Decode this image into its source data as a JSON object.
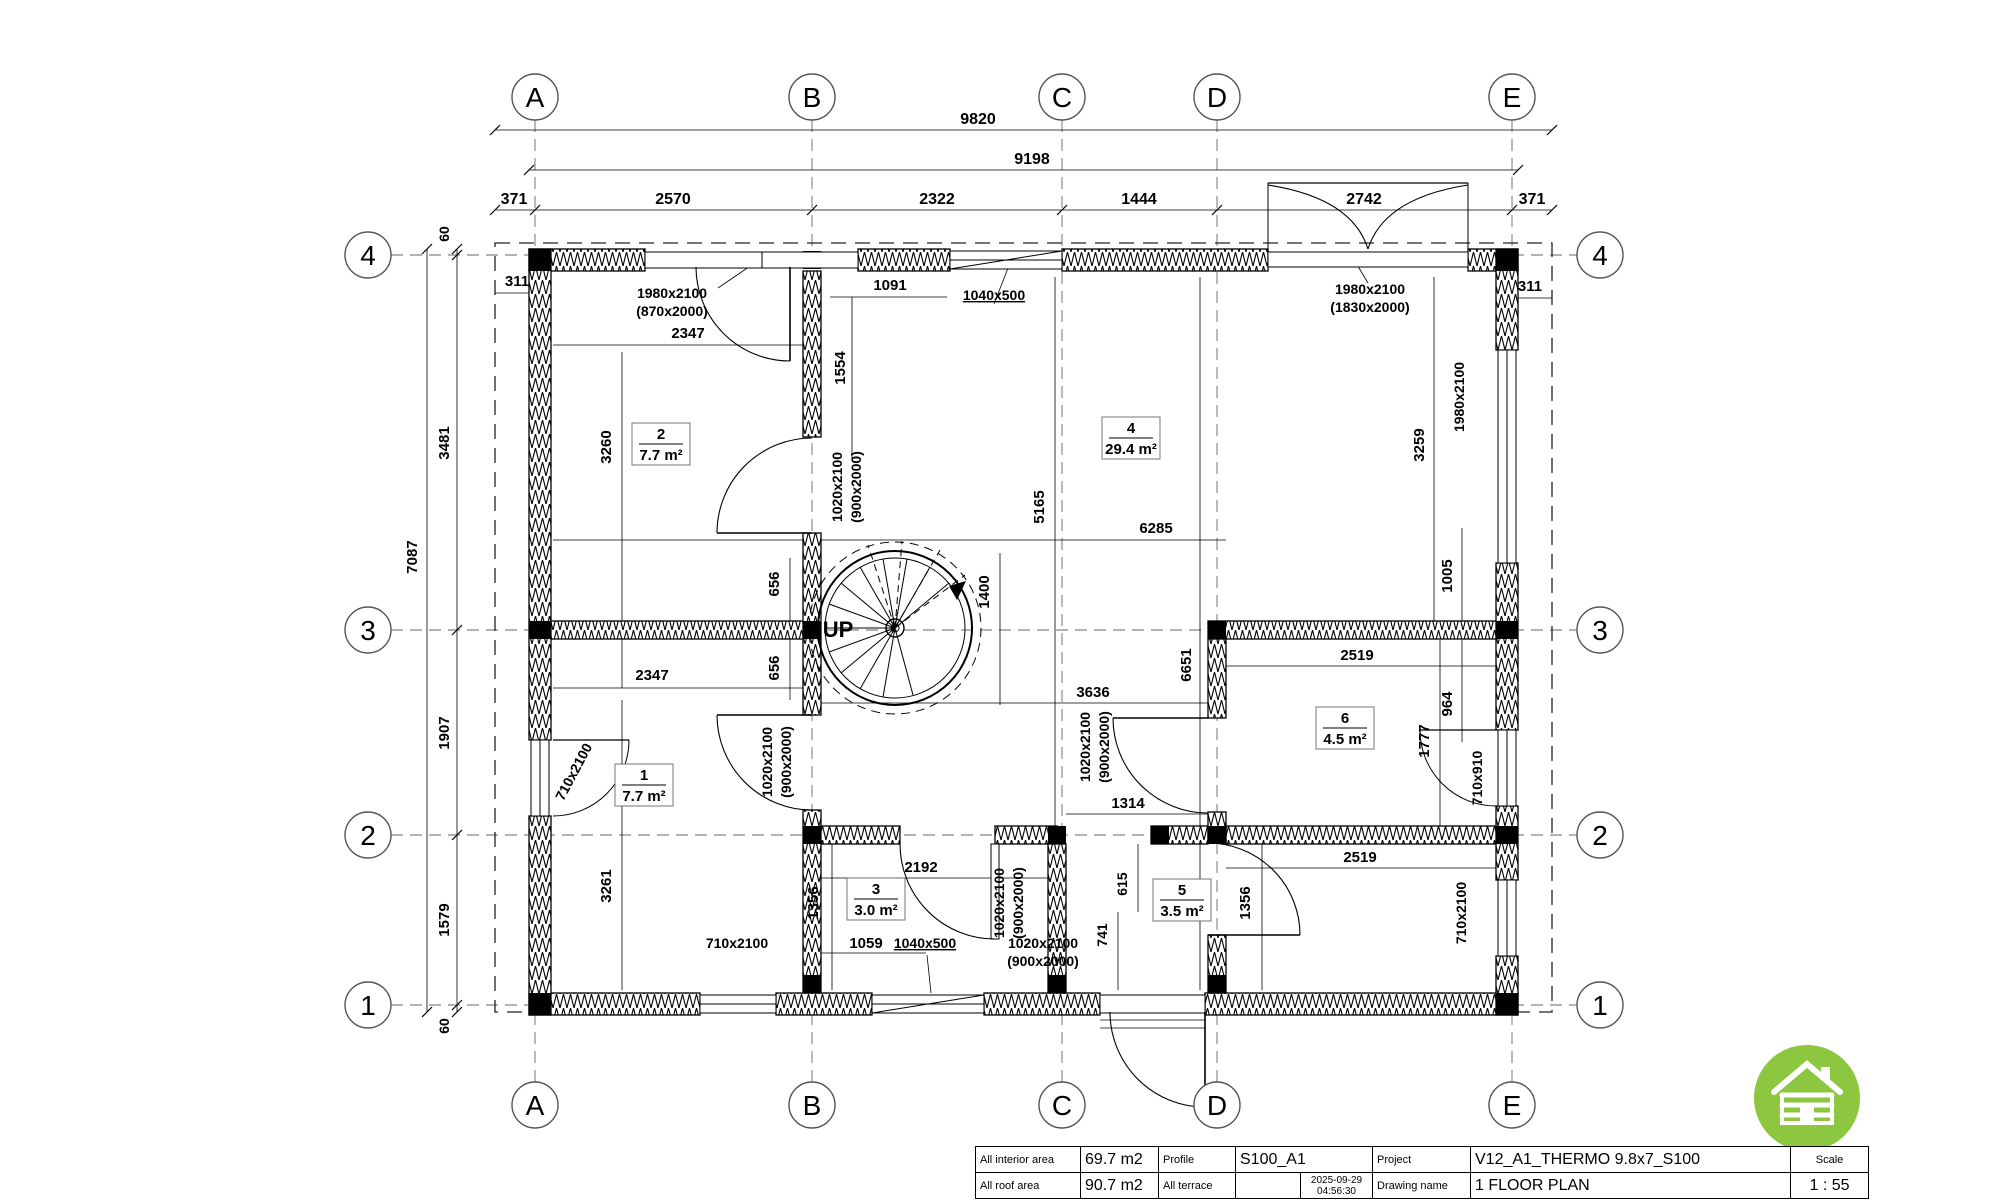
{
  "page": {
    "bg": "#ffffff",
    "line_color": "#000000",
    "accent_green": "#8dc63f"
  },
  "grid": {
    "col_labels": [
      "A",
      "B",
      "C",
      "D",
      "E"
    ],
    "row_labels": [
      "4",
      "3",
      "2",
      "1"
    ]
  },
  "bubbles": [
    {
      "t": "A",
      "x": 535,
      "y": 97
    },
    {
      "t": "B",
      "x": 812,
      "y": 97
    },
    {
      "t": "C",
      "x": 1062,
      "y": 97
    },
    {
      "t": "D",
      "x": 1217,
      "y": 97
    },
    {
      "t": "E",
      "x": 1512,
      "y": 97
    },
    {
      "t": "A",
      "x": 535,
      "y": 1105
    },
    {
      "t": "B",
      "x": 812,
      "y": 1105
    },
    {
      "t": "C",
      "x": 1062,
      "y": 1105
    },
    {
      "t": "D",
      "x": 1217,
      "y": 1105
    },
    {
      "t": "E",
      "x": 1512,
      "y": 1105
    },
    {
      "t": "4",
      "x": 368,
      "y": 255
    },
    {
      "t": "3",
      "x": 368,
      "y": 630
    },
    {
      "t": "2",
      "x": 368,
      "y": 835
    },
    {
      "t": "1",
      "x": 368,
      "y": 1005
    },
    {
      "t": "4",
      "x": 1600,
      "y": 255
    },
    {
      "t": "3",
      "x": 1600,
      "y": 630
    },
    {
      "t": "2",
      "x": 1600,
      "y": 835
    },
    {
      "t": "1",
      "x": 1600,
      "y": 1005
    }
  ],
  "annotations": [
    {
      "t": "9820",
      "x": 978,
      "y": 124,
      "s": 16
    },
    {
      "t": "9198",
      "x": 1032,
      "y": 164,
      "s": 16
    },
    {
      "t": "371",
      "x": 514,
      "y": 204,
      "s": 16
    },
    {
      "t": "2570",
      "x": 673,
      "y": 204,
      "s": 16
    },
    {
      "t": "2322",
      "x": 937,
      "y": 204,
      "s": 16
    },
    {
      "t": "1444",
      "x": 1139,
      "y": 204,
      "s": 16
    },
    {
      "t": "2742",
      "x": 1364,
      "y": 204,
      "s": 16
    },
    {
      "t": "371",
      "x": 1532,
      "y": 204,
      "s": 16
    },
    {
      "t": "311",
      "x": 517,
      "y": 286,
      "s": 15
    },
    {
      "t": "311",
      "x": 1530,
      "y": 291,
      "s": 15
    },
    {
      "t": "60",
      "x": 449,
      "y": 234,
      "r": -90,
      "s": 14
    },
    {
      "t": "3481",
      "x": 449,
      "y": 443,
      "r": -90,
      "s": 15
    },
    {
      "t": "1907",
      "x": 449,
      "y": 733,
      "r": -90,
      "s": 15
    },
    {
      "t": "1579",
      "x": 449,
      "y": 920,
      "r": -90,
      "s": 15
    },
    {
      "t": "60",
      "x": 449,
      "y": 1026,
      "r": -90,
      "s": 14
    },
    {
      "t": "7087",
      "x": 417,
      "y": 557,
      "r": -90,
      "s": 15
    },
    {
      "t": "1980x2100",
      "x": 672,
      "y": 298,
      "s": 14,
      "n": "door-size-label"
    },
    {
      "t": "(870x2000)",
      "x": 672,
      "y": 316,
      "s": 14,
      "n": "door-size-label"
    },
    {
      "t": "1040x500",
      "x": 994,
      "y": 300,
      "s": 14,
      "u": 1,
      "n": "window-size-label"
    },
    {
      "t": "1980x2100",
      "x": 1370,
      "y": 294,
      "s": 14,
      "n": "door-size-label"
    },
    {
      "t": "(1830x2000)",
      "x": 1370,
      "y": 312,
      "s": 14,
      "n": "door-size-label"
    },
    {
      "t": "1980x2100",
      "x": 1464,
      "y": 397,
      "r": -90,
      "s": 14,
      "n": "window-size-label"
    },
    {
      "t": "710x2100",
      "x": 578,
      "y": 774,
      "r": -62,
      "s": 14,
      "n": "window-size-label"
    },
    {
      "t": "1020x2100",
      "x": 842,
      "y": 487,
      "r": -90,
      "s": 14,
      "n": "door-size-label"
    },
    {
      "t": "(900x2000)",
      "x": 861,
      "y": 487,
      "r": -90,
      "s": 14,
      "n": "door-size-label"
    },
    {
      "t": "1020x2100",
      "x": 772,
      "y": 762,
      "r": -90,
      "s": 14,
      "n": "door-size-label"
    },
    {
      "t": "(900x2000)",
      "x": 791,
      "y": 762,
      "r": -90,
      "s": 14,
      "n": "door-size-label"
    },
    {
      "t": "1020x2100",
      "x": 1090,
      "y": 747,
      "r": -90,
      "s": 14,
      "n": "door-size-label"
    },
    {
      "t": "(900x2000)",
      "x": 1109,
      "y": 747,
      "r": -90,
      "s": 14,
      "n": "door-size-label"
    },
    {
      "t": "1020x2100",
      "x": 1004,
      "y": 903,
      "r": -90,
      "s": 14,
      "n": "door-size-label"
    },
    {
      "t": "(900x2000)",
      "x": 1023,
      "y": 903,
      "r": -90,
      "s": 14,
      "n": "door-size-label"
    },
    {
      "t": "710x910",
      "x": 1482,
      "y": 778,
      "r": -90,
      "s": 14,
      "n": "window-size-label"
    },
    {
      "t": "710x2100",
      "x": 1466,
      "y": 913,
      "r": -90,
      "s": 14,
      "n": "window-size-label"
    },
    {
      "t": "710x2100",
      "x": 737,
      "y": 948,
      "s": 14,
      "n": "window-size-label"
    },
    {
      "t": "1040x500",
      "x": 925,
      "y": 948,
      "s": 14,
      "u": 1,
      "n": "window-size-label"
    },
    {
      "t": "1020x2100",
      "x": 1043,
      "y": 948,
      "s": 14,
      "n": "door-size-label"
    },
    {
      "t": "(900x2000)",
      "x": 1043,
      "y": 966,
      "s": 14,
      "n": "door-size-label"
    },
    {
      "t": "2347",
      "x": 688,
      "y": 338,
      "s": 15
    },
    {
      "t": "1091",
      "x": 890,
      "y": 290,
      "s": 15
    },
    {
      "t": "1554",
      "x": 845,
      "y": 368,
      "r": -90,
      "s": 15
    },
    {
      "t": "3260",
      "x": 611,
      "y": 447,
      "r": -90,
      "s": 15
    },
    {
      "t": "3259",
      "x": 1424,
      "y": 445,
      "r": -90,
      "s": 15
    },
    {
      "t": "1005",
      "x": 1452,
      "y": 576,
      "r": -90,
      "s": 15
    },
    {
      "t": "5165",
      "x": 1044,
      "y": 507,
      "r": -90,
      "s": 15
    },
    {
      "t": "6285",
      "x": 1156,
      "y": 533,
      "s": 15
    },
    {
      "t": "656",
      "x": 779,
      "y": 584,
      "r": -90,
      "s": 15
    },
    {
      "t": "656",
      "x": 779,
      "y": 668,
      "r": -90,
      "s": 15
    },
    {
      "t": "1400",
      "x": 989,
      "y": 592,
      "r": -90,
      "s": 15
    },
    {
      "t": "2347",
      "x": 652,
      "y": 680,
      "s": 15
    },
    {
      "t": "3636",
      "x": 1093,
      "y": 697,
      "s": 15
    },
    {
      "t": "6651",
      "x": 1191,
      "y": 665,
      "r": -90,
      "s": 15
    },
    {
      "t": "2519",
      "x": 1357,
      "y": 660,
      "s": 15
    },
    {
      "t": "964",
      "x": 1452,
      "y": 704,
      "r": -90,
      "s": 15
    },
    {
      "t": "1777",
      "x": 1429,
      "y": 741,
      "r": -90,
      "s": 15
    },
    {
      "t": "2519",
      "x": 1360,
      "y": 862,
      "s": 15
    },
    {
      "t": "2192",
      "x": 921,
      "y": 872,
      "s": 15
    },
    {
      "t": "1314",
      "x": 1128,
      "y": 808,
      "s": 15
    },
    {
      "t": "1356",
      "x": 818,
      "y": 903,
      "r": -90,
      "s": 15
    },
    {
      "t": "1356",
      "x": 1250,
      "y": 903,
      "r": -90,
      "s": 15
    },
    {
      "t": "615",
      "x": 1127,
      "y": 884,
      "r": -90,
      "s": 14
    },
    {
      "t": "741",
      "x": 1107,
      "y": 935,
      "r": -90,
      "s": 14
    },
    {
      "t": "3261",
      "x": 611,
      "y": 886,
      "r": -90,
      "s": 15
    },
    {
      "t": "1059",
      "x": 866,
      "y": 948,
      "s": 15
    },
    {
      "t": "UP",
      "x": 838,
      "y": 637,
      "s": 22,
      "b": 1,
      "n": "stair-up-label"
    }
  ],
  "rooms": [
    {
      "n": "2",
      "a": "7.7 m²",
      "x": 661,
      "y": 444
    },
    {
      "n": "4",
      "a": "29.4 m²",
      "x": 1131,
      "y": 438
    },
    {
      "n": "1",
      "a": "7.7 m²",
      "x": 644,
      "y": 785
    },
    {
      "n": "3",
      "a": "3.0 m²",
      "x": 876,
      "y": 899
    },
    {
      "n": "5",
      "a": "3.5 m²",
      "x": 1182,
      "y": 900
    },
    {
      "n": "6",
      "a": "4.5 m²",
      "x": 1345,
      "y": 728
    }
  ],
  "titleblock": {
    "interior_label": "All interior area",
    "interior_value": "69.7 m2",
    "roof_label": "All roof area",
    "roof_value": "90.7 m2",
    "profile_label": "Profile",
    "profile_value": "S100_A1",
    "terrace_label": "All terrace",
    "terrace_value": "",
    "date": "2025-09-29",
    "time": "04:56:30",
    "project_label": "Project",
    "project_value": "V12_A1_THERMO 9.8x7_S100",
    "drawing_label": "Drawing name",
    "drawing_value": "1 FLOOR PLAN",
    "scale_label": "Scale",
    "scale_value": "1 : 55"
  },
  "logo": {
    "icon": "log-cabin-icon",
    "color": "#8dc63f"
  }
}
